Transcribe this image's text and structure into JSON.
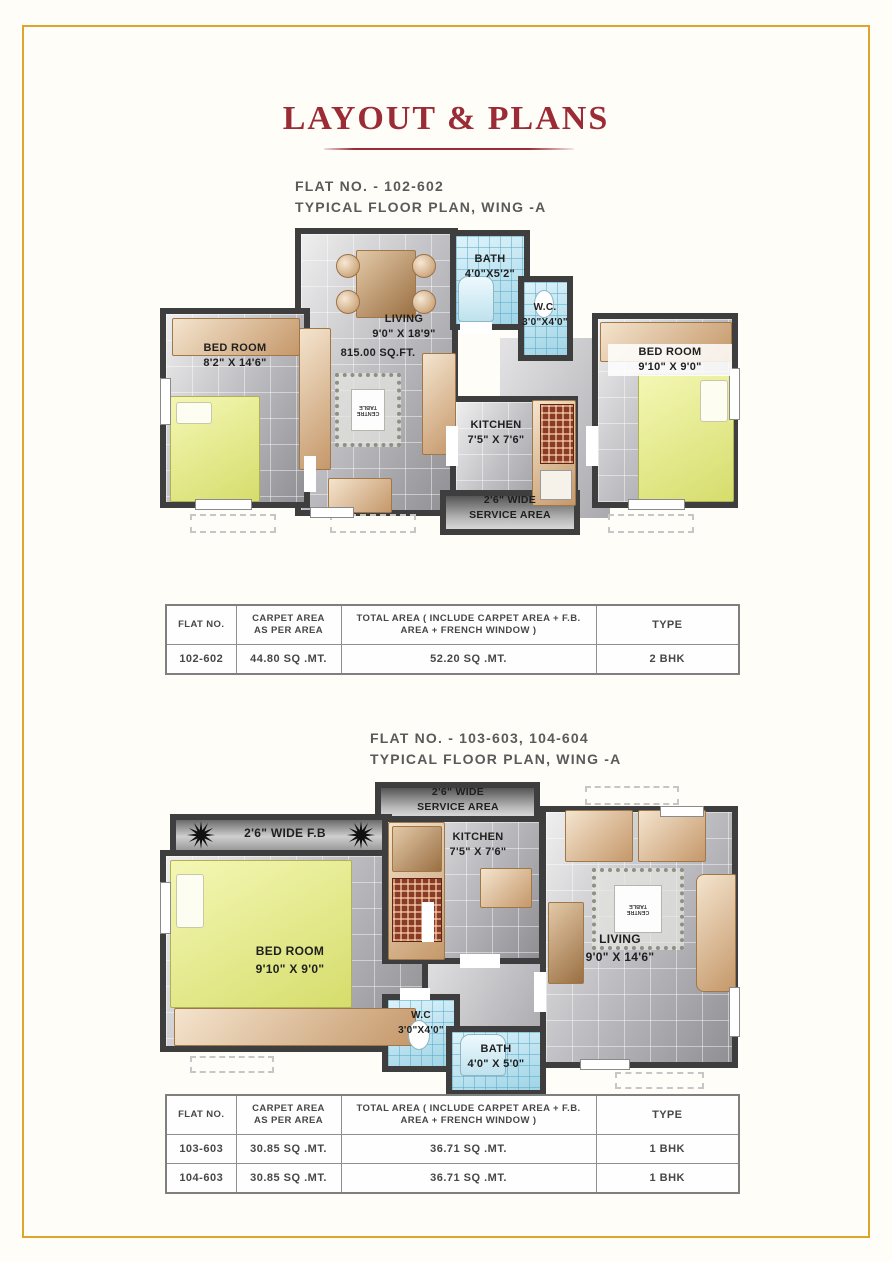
{
  "page": {
    "title": "LAYOUT & PLANS",
    "accent_color": "#9b2b35",
    "frame_color": "#dea52c"
  },
  "plan1": {
    "heading_line1": "FLAT NO. - 102-602",
    "heading_line2": "TYPICAL FLOOR PLAN, WING -A",
    "living_name": "LIVING",
    "living_dim": "9'0\" X 18'9\"",
    "total_area": "815.00 SQ.FT.",
    "bed_left_name": "BED ROOM",
    "bed_left_dim": "8'2\" X 14'6\"",
    "bed_right_name": "BED ROOM",
    "bed_right_dim": "9'10\" X 9'0\"",
    "bath_name": "BATH",
    "bath_dim": "4'0\"X5'2\"",
    "wc_name": "W.C.",
    "wc_dim": "3'0\"X4'0\"",
    "kitchen_name": "KITCHEN",
    "kitchen_dim": "7'5\" X 7'6\"",
    "service_line1": "2'6\" WIDE",
    "service_line2": "SERVICE AREA",
    "centre_table": "CENTRE TABLE"
  },
  "table_headers": [
    "FLAT NO.",
    "CARPET AREA AS PER AREA",
    "TOTAL AREA ( INCLUDE CARPET AREA + F.B. AREA + FRENCH WINDOW )",
    "TYPE"
  ],
  "table1": {
    "rows": [
      [
        "102-602",
        "44.80 SQ .MT.",
        "52.20 SQ .MT.",
        "2 BHK"
      ]
    ]
  },
  "plan2": {
    "heading_line1": "FLAT NO. - 103-603, 104-604",
    "heading_line2": "TYPICAL FLOOR PLAN, WING -A",
    "fb_label": "2'6\" WIDE F.B",
    "service_line1": "2'6\" WIDE",
    "service_line2": "SERVICE AREA",
    "kitchen_name": "KITCHEN",
    "kitchen_dim": "7'5\" X 7'6\"",
    "bedroom_name": "BED ROOM",
    "bedroom_dim": "9'10\" X 9'0\"",
    "living_name": "LIVING",
    "living_dim": "9'0\" X 14'6\"",
    "wc_name": "W.C",
    "wc_dim": "3'0\"X4'0\"",
    "bath_name": "BATH",
    "bath_dim": "4'0\" X 5'0\"",
    "centre_table": "CENTRE TABLE"
  },
  "table2": {
    "rows": [
      [
        "103-603",
        "30.85 SQ .MT.",
        "36.71 SQ .MT.",
        "1 BHK"
      ],
      [
        "104-603",
        "30.85 SQ .MT.",
        "36.71 SQ .MT.",
        "1 BHK"
      ]
    ]
  }
}
